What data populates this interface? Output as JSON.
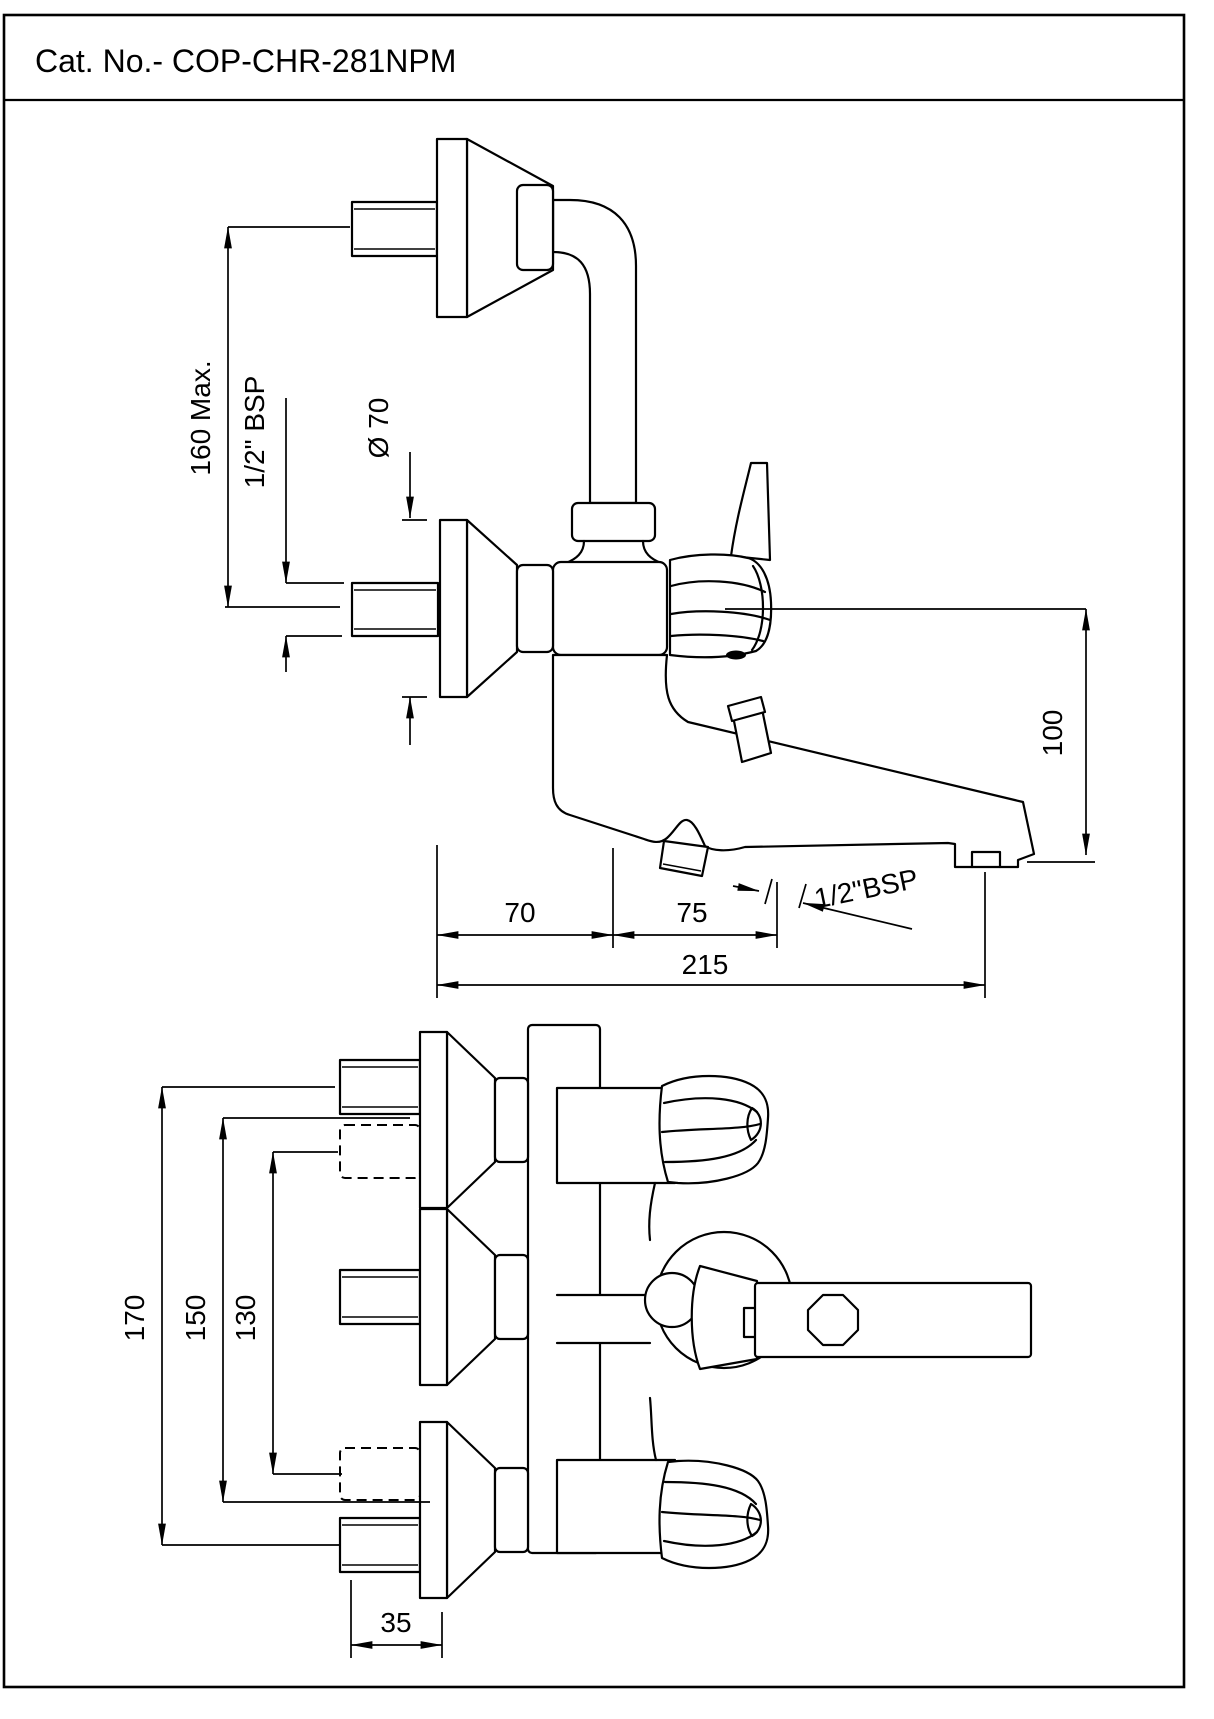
{
  "title": "Cat. No.- COP-CHR-281NPM",
  "side_view": {
    "description": "wall mixer side elevation with bend pipe, two wall flanges, knob, lever and bath spout",
    "dimensions": {
      "height_max": "160 Max.",
      "inlet_thread": "1/2\" BSP",
      "flange_diameter": "Ø 70",
      "spout_drop": "100",
      "wall_to_diverter": "70",
      "diverter_to_outlet": "75",
      "total_projection": "215",
      "outlet_thread": "1/2\"BSP"
    }
  },
  "front_view": {
    "description": "wall mixer front elevation with three wall flanges, two knobs, diverter and spout",
    "dimensions": {
      "outer_centers": "170",
      "alternate_centers": "150",
      "hidden_centers": "130",
      "nipple_length": "35"
    }
  }
}
